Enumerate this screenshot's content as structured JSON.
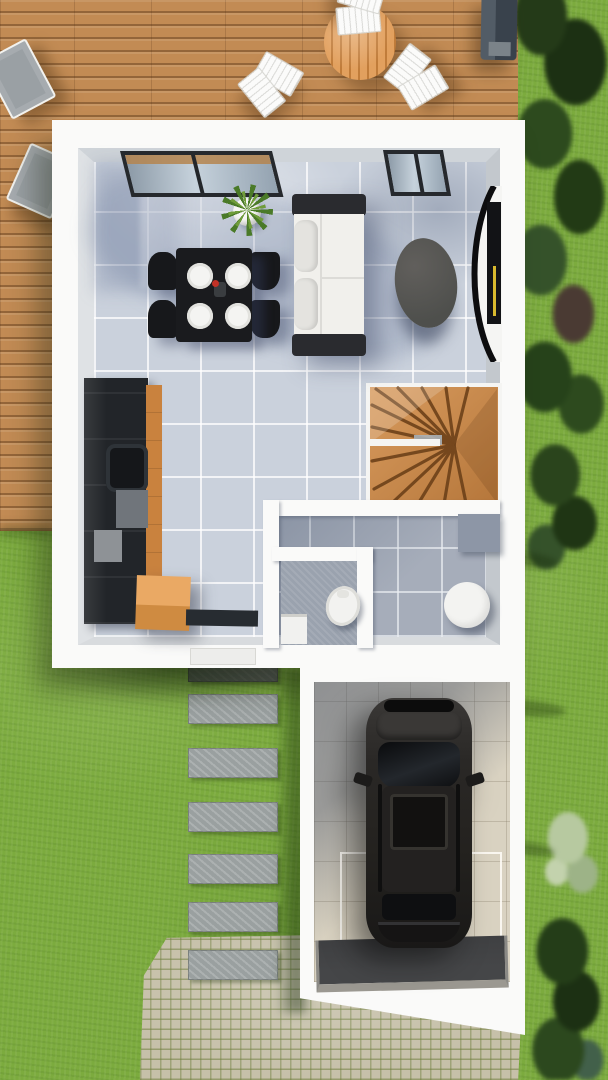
{
  "scene": {
    "type": "3d-floor-plan-render",
    "view": "top-down",
    "description": "Top-down 3D architectural rendering of a small house ground floor: wooden deck terrace with outdoor furniture at top, open living/dining room with kitchen, winder staircase, WC and shower room, attached garage with dark SUV, lawn, paver path and cobblestone driveway"
  },
  "palette": {
    "grass": "#7cab3e",
    "deck_wood": "#c28b54",
    "table_wood": "#e2a05e",
    "chair_white": "#fbfbfa",
    "lounger_gray": "#9aa0a4",
    "grill_gray": "#39424c",
    "house_white": "#fafaf9",
    "wall_face": "#cfd4d9",
    "tile_light": "#cad1dc",
    "tile_hall": "#a6adba",
    "tile_wc": "#9aa2ae",
    "kitchen_black": "#222529",
    "wood_accent": "#c9823e",
    "crate_top": "#eaa964",
    "crate_side": "#cf8b41",
    "doormat_dark": "#272c31",
    "dining_black": "#1a1b1e",
    "plate_white": "#f4f4f2",
    "plant_green": "#4a7a28",
    "pot_white": "#f6f6f4",
    "sofa_white": "#f1f0ec",
    "sofa_arm": "#2a2b2f",
    "coffee_gray": "#565754",
    "tv_black": "#121316",
    "tv_accent_yellow": "#d8b92e",
    "stair_wood": "#c98a49",
    "stair_gap": "#6d4119",
    "window_frame": "#26292d",
    "toilet_white": "#f2f2f0",
    "basin_white": "#f3f3f1",
    "cabinet_gray": "#8d96a6",
    "garage_floor": "#d9d2c1",
    "ramp_dark": "#454648",
    "ramp_edge": "#9b9891",
    "car_body": "#24221f",
    "car_glass": "#0d0e10",
    "paver_gray": "#9aa0a0",
    "cobble_base": "#c6c0a9",
    "hedge_dark": "#2c451d",
    "bush_light": "#b7c9a0"
  },
  "objects": {
    "outdoor": [
      "wooden-deck",
      "round-slat-table",
      "folding-chairs",
      "sun-loungers",
      "barbecue-grill",
      "hedge",
      "lawn",
      "paver-path",
      "cobblestone-driveway"
    ],
    "living_dining": [
      "dining-table-with-plates",
      "dining-chairs",
      "potted-plant",
      "sofa",
      "oval-coffee-table",
      "curved-tv-unit",
      "glazed-windows"
    ],
    "kitchen": [
      "dark-kitchen-counter",
      "sink",
      "wood-crate",
      "doormat"
    ],
    "circulation": [
      "winder-staircase",
      "hallway"
    ],
    "bathroom": [
      "toilet",
      "round-basin",
      "cabinet"
    ],
    "garage": [
      "dark-suv",
      "garage-ramp",
      "garage-door-frame"
    ]
  }
}
